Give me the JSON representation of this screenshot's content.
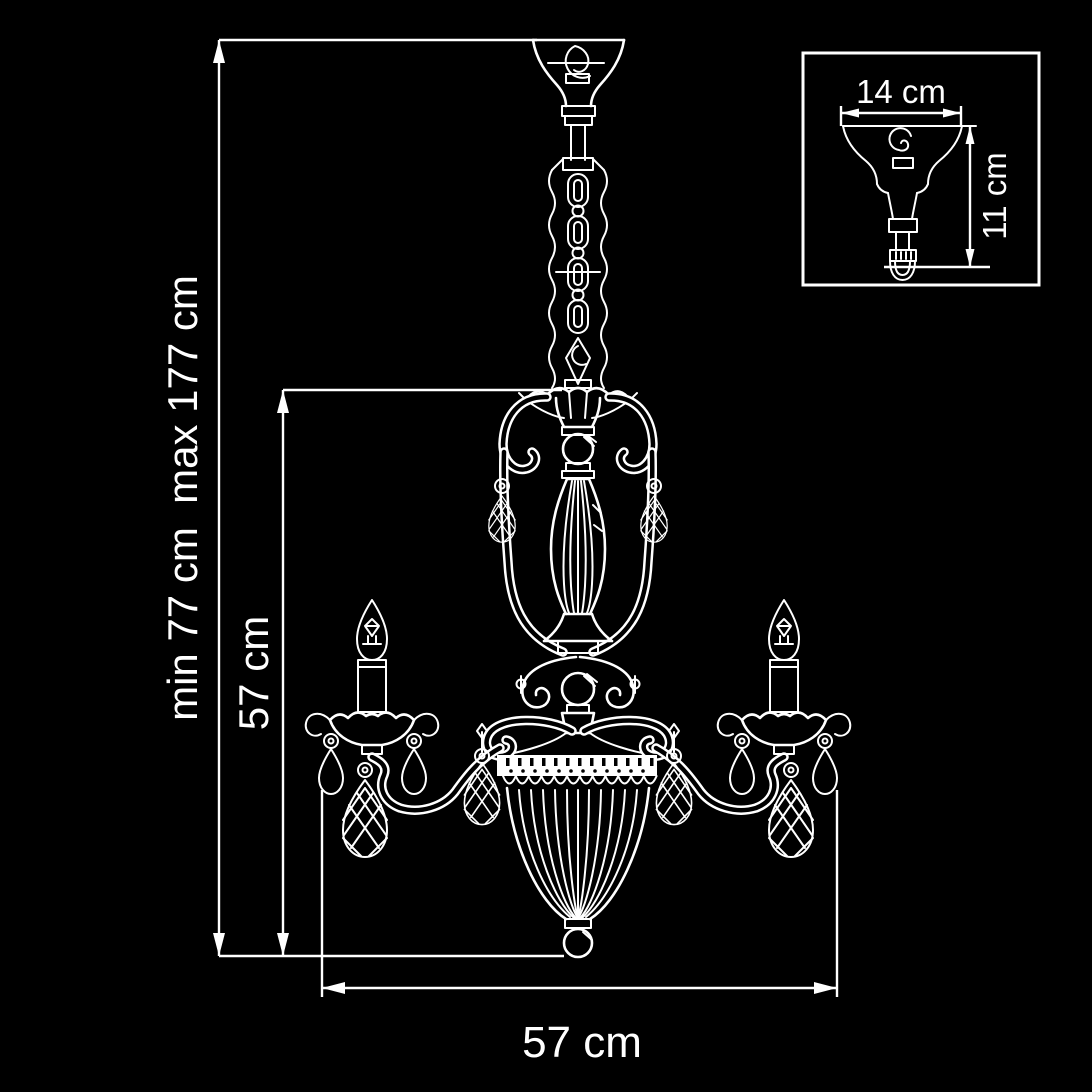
{
  "page": {
    "background_color": "#000000",
    "line_color": "#ffffff"
  },
  "dimensions": {
    "overall_height": "min 77 cm  max 177 cm",
    "fixture_height": "57 cm",
    "fixture_width": "57 cm",
    "inset": {
      "canopy_width": "14 cm",
      "canopy_drop": "11 cm"
    }
  },
  "drawing_parts": [
    "ceiling-canopy",
    "suspension-hook",
    "chain-column",
    "crown-bobeche",
    "lyre-stem",
    "fluted-vase",
    "scroll-ornaments",
    "candle-arms",
    "candle-bulbs",
    "crystal-drops",
    "beaded-ribbed-bowl",
    "finial-ball"
  ]
}
